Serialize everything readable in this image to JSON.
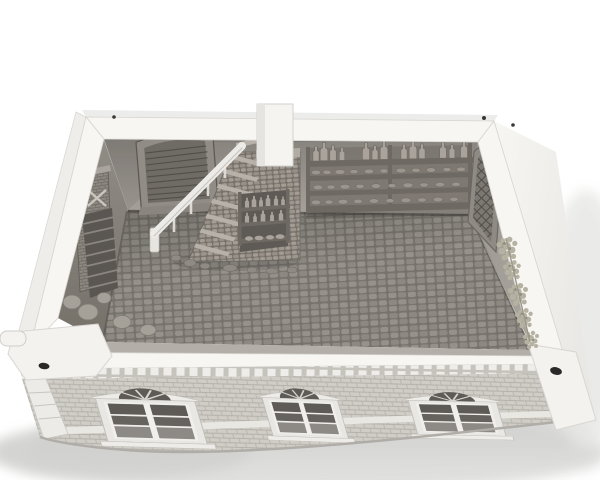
{
  "scene": {
    "subject": "roofless miniature building interior 3D render, viewed from above-front",
    "palette": {
      "background": "#ffffff",
      "ground_shadow": "#c7c7c5",
      "ground_shadow_soft": "#e2e2e0",
      "exterior_wall": "#f4f3f0",
      "rim_top": "#f7f6f3",
      "edge_line": "#d6d3ce",
      "interior_back_top": "#87837d",
      "interior_back_bottom": "#a6a19a",
      "interior_left_top": "#918d87",
      "interior_left_bottom": "#757169",
      "interior_right": "#a9a49d",
      "front_inner_sliver": "#b3aea7",
      "floor_gap": "#76726c",
      "floor_stone": "#8d8982",
      "floor_stone_alt": "#96928b",
      "stair_mortar": "#757069",
      "stair_stone": "#a39d95",
      "tread_highlight": "#b7b1a9",
      "handrail": "#edebe7",
      "door_frame": "#918c86",
      "door_planks": "#6f6b65",
      "door_slat_line": "#524f4a",
      "shelf_wood": "#6e6963",
      "shelf_back": "#7b766f",
      "bottle": "#a9a39b",
      "jar": "#9b958d",
      "brick_face": "#d0cdc7",
      "brick_line": "#b4b1ab",
      "chimney_brick": "#8d8880",
      "chimney_mortar": "#6e6a64",
      "trim": "#eeece8",
      "window_dark": "#5e5b56",
      "window_mid": "#8d8984",
      "lattice_bg": "#7c7872",
      "lattice_line": "#52504b",
      "vine": "#b5b2a2",
      "vine_dark": "#8f8c7e",
      "hole": "#2b2927",
      "dentil_gap": "#c6c3bd",
      "ladder_panel": "#5a5651",
      "ladder_slat": "#8a857e",
      "sack": "#a5a098"
    },
    "objects": {
      "back_door": "arched plank door",
      "staircase": "stone staircase",
      "handrail": "white handrail",
      "chimney": "white chimney column",
      "stair_bottle_rack": "small bottle rack on staircase",
      "wall_shelf": {
        "tiers": 4,
        "standing_bottles": 13
      },
      "lattice_window": "diamond lattice window",
      "vine_clusters": 5,
      "fireplace_corner": "brick fireplace with ladder and sacks",
      "facade": {
        "windows": 3,
        "finish": "brick with stone trim and dentil cornice"
      },
      "corner_peg": 1,
      "magnet_holes": 2,
      "floor": "cobblestone flagstone floor"
    }
  }
}
